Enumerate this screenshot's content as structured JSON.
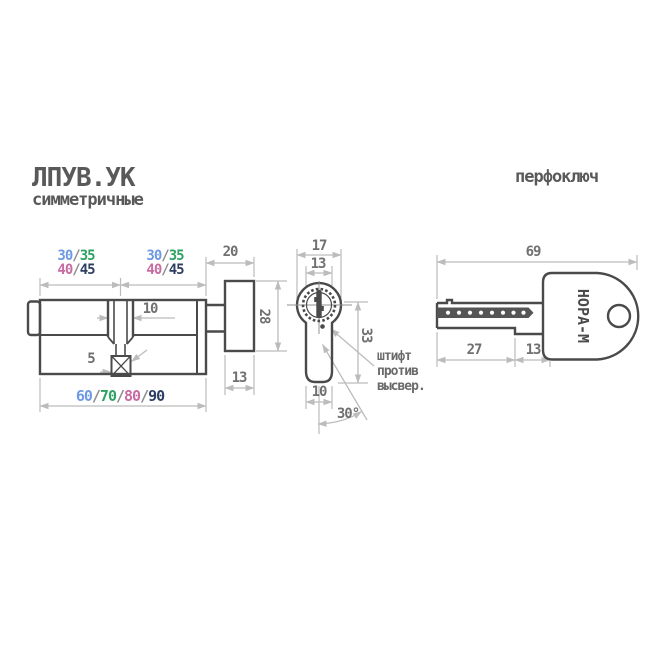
{
  "page": {
    "title": "ЛПУВ.УК",
    "subtitle": "симметричные",
    "key_type_label": "перфоключ"
  },
  "separator": "/",
  "colors": {
    "size_1_blue": "#6e9ae4",
    "size_2_green": "#2da361",
    "size_3_pink": "#c76ba1",
    "size_4_navy": "#2e3e62",
    "separator_gray": "#8c8c8c",
    "outline_gray": "#4a4a4a",
    "dimension_line_gray": "#bcbcbc",
    "dimension_text_gray": "#707070",
    "title_gray": "#595959"
  },
  "side_view": {
    "half_lengths_top": [
      "30",
      "35"
    ],
    "half_lengths_bottom": [
      "40",
      "45"
    ],
    "overall_lengths": [
      "60",
      "70",
      "80",
      "90"
    ],
    "cam_slot_width": "10",
    "cam_tip_offset": "5",
    "cam_assembly_width": "20",
    "cam_height": "28",
    "cam_thickness": "13"
  },
  "profile_view": {
    "body_width": "17",
    "plug_width": "13",
    "profile_height": "33",
    "fin_width": "10",
    "key_turn_angle": "30°",
    "note": [
      "штифт",
      "против",
      "высвер."
    ]
  },
  "key_view": {
    "total_length": "69",
    "blade_length": "27",
    "shoulder_width": "13",
    "brand": "НОРА-М"
  }
}
